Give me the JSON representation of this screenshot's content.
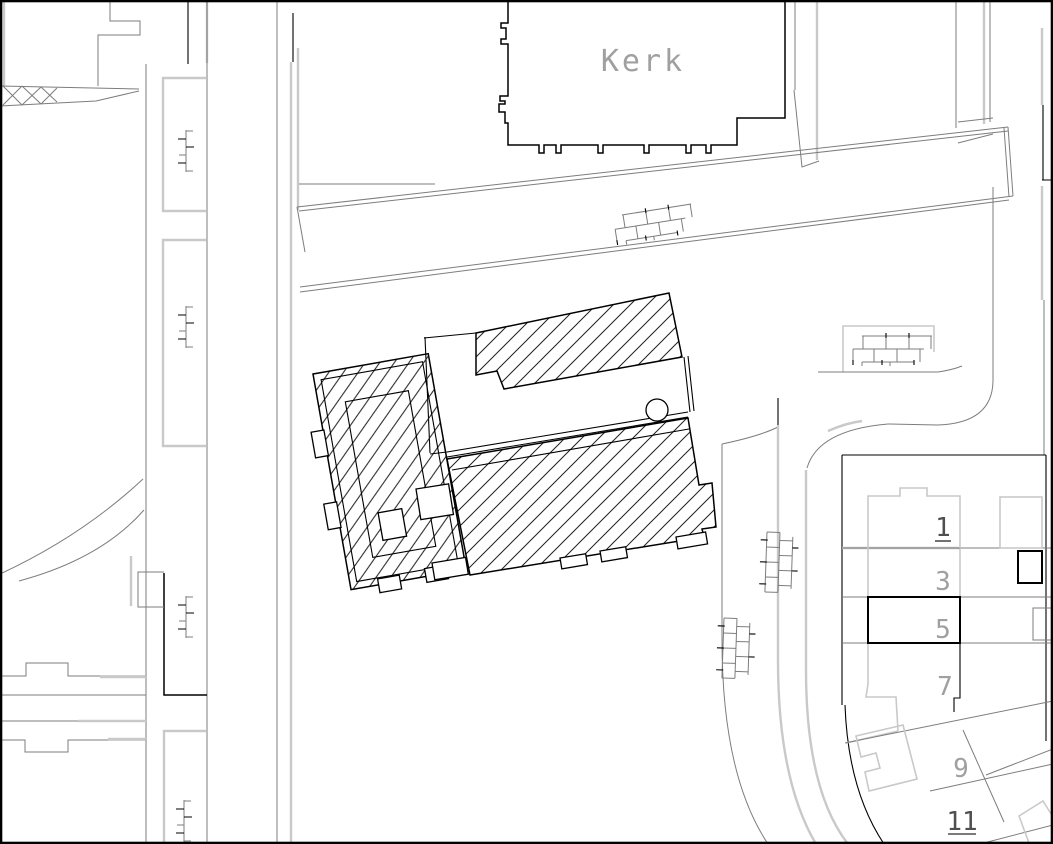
{
  "labels": {
    "church": "Kerk"
  },
  "house_numbers": {
    "h1": {
      "label": "1",
      "underlined": true
    },
    "h3": {
      "label": "3",
      "underlined": false
    },
    "h5": {
      "label": "5",
      "underlined": false
    },
    "h7": {
      "label": "7",
      "underlined": false
    },
    "h9": {
      "label": "9",
      "underlined": false
    },
    "h11": {
      "label": "11",
      "underlined": true
    }
  },
  "symbols": {
    "wall": "brick-wall-symbol",
    "survey_mark": "ladder-tick-symbol",
    "tree": "circle-tree-symbol"
  },
  "colors": {
    "ink": "#000000",
    "dark": "#7d7d7d",
    "light": "#c9c9c9",
    "label": "#a0a0a0",
    "label-strong": "#4f4f4f",
    "paper": "#ffffff"
  }
}
